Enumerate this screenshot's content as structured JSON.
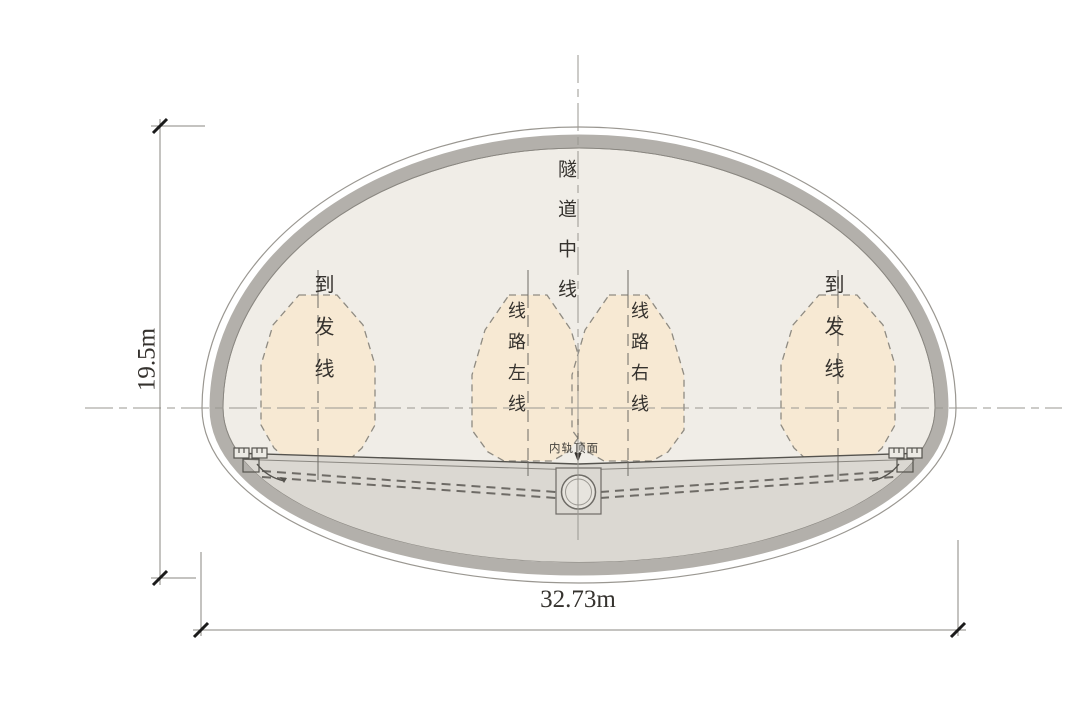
{
  "drawing": {
    "type": "tunnel-cross-section",
    "labels": {
      "tunnel_centerline": "隧道中线",
      "arrival_departure_track_left": "到发线",
      "route_left_line": "线路左线",
      "route_right_line": "线路右线",
      "arrival_departure_track_right": "到发线",
      "rail_top_surface": "内轨顶面"
    },
    "dimensions": {
      "height": "19.5m",
      "width": "32.73m"
    },
    "colors": {
      "background": "#ffffff",
      "lining_band": "#b3b0ab",
      "interior_fill": "#f0ede7",
      "track_bed_fill": "#dbd8d2",
      "clearance_envelope_fill": "#f7e9d3",
      "line_gray": "#8a8781",
      "dark_line": "#55534e",
      "tick_black": "#1b1b1b",
      "text": "#35322e"
    }
  }
}
